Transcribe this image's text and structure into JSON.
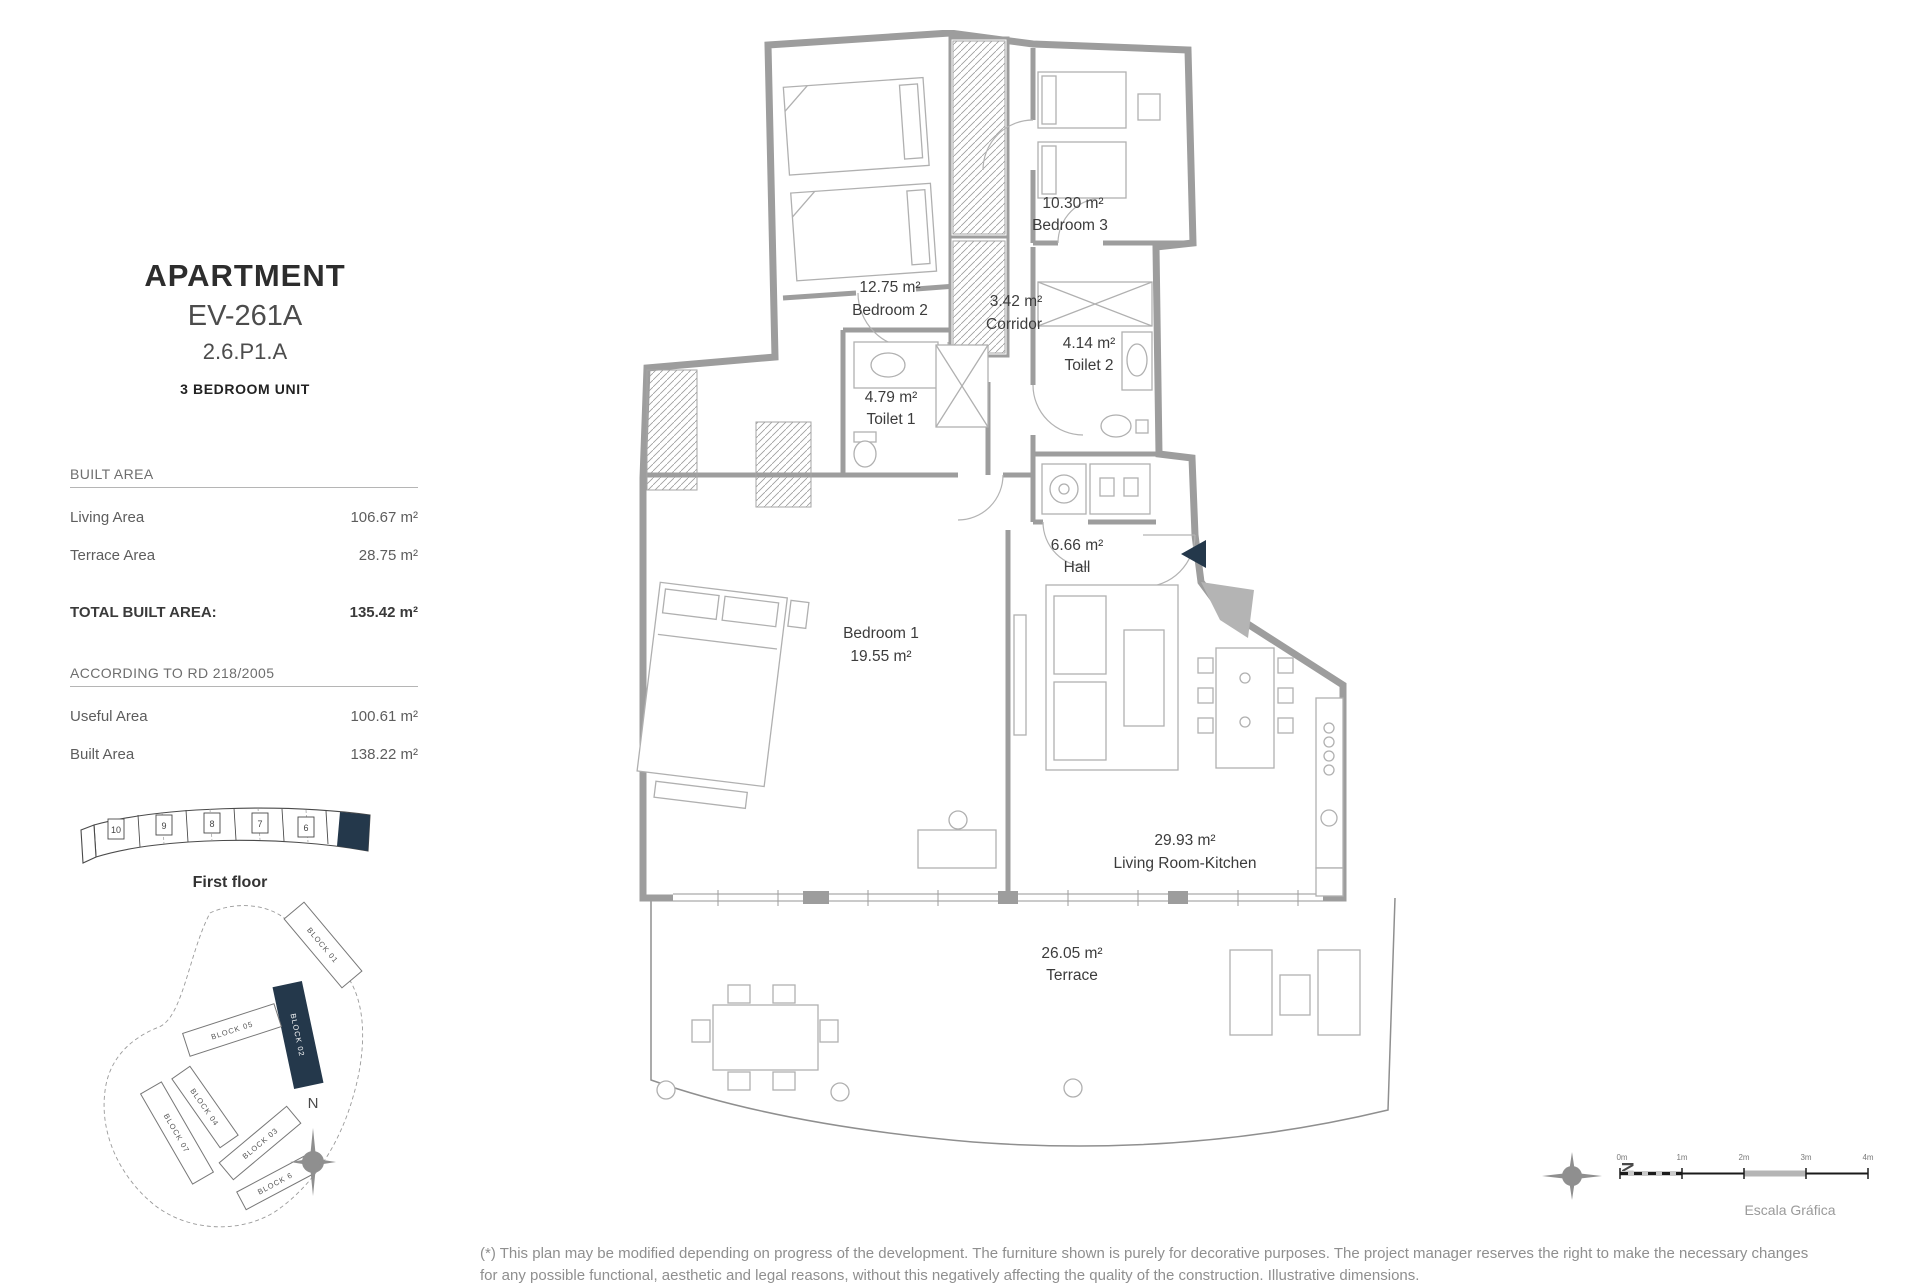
{
  "header": {
    "title": "APARTMENT",
    "unit_code": "EV-261A",
    "unit_ref": "2.6.P1.A",
    "unit_type": "3 BEDROOM UNIT"
  },
  "built_area": {
    "section_title": "BUILT AREA",
    "rows": [
      {
        "label": "Living Area",
        "value": "106.67 m²"
      },
      {
        "label": "Terrace Area",
        "value": "28.75 m²"
      }
    ],
    "total_label": "TOTAL BUILT AREA:",
    "total_value": "135.42 m²"
  },
  "rd_section": {
    "section_title": "ACCORDING TO RD 218/2005",
    "rows": [
      {
        "label": "Useful Area",
        "value": "100.61 m²"
      },
      {
        "label": "Built Area",
        "value": "138.22 m²"
      }
    ]
  },
  "floor_strip": {
    "label": "First floor",
    "units": [
      "10",
      "9",
      "8",
      "7",
      "6"
    ]
  },
  "site_plan": {
    "blocks": [
      "BLOCK 01",
      "BLOCK 02",
      "BLOCK 05",
      "BLOCK 04",
      "BLOCK 07",
      "BLOCK 03",
      "BLOCK 6"
    ],
    "highlighted_block": "BLOCK 02",
    "north_label": "N"
  },
  "floor_plan": {
    "rooms": [
      {
        "name": "Bedroom 3",
        "area": "10.30 m²"
      },
      {
        "name": "Bedroom 2",
        "area": "12.75 m²"
      },
      {
        "name": "Corridor",
        "area": "3.42 m²"
      },
      {
        "name": "Toilet 2",
        "area": "4.14 m²"
      },
      {
        "name": "Toilet 1",
        "area": "4.79 m²"
      },
      {
        "name": "Hall",
        "area": "6.66 m²"
      },
      {
        "name": "Bedroom 1",
        "area": "19.55 m²"
      },
      {
        "name": "Living Room-Kitchen",
        "area": "29.93 m²"
      },
      {
        "name": "Terrace",
        "area": "26.05 m²"
      }
    ]
  },
  "scale_bar": {
    "title": "Escala Gráfica",
    "ticks": [
      "0m",
      "1m",
      "2m",
      "3m",
      "4m"
    ],
    "north_label": "N"
  },
  "footer": {
    "disclaimer": "(*) This plan may be modified depending on progress of the development. The furniture shown is purely for decorative purposes. The project manager reserves the right to make the necessary changes for any possible functional, aesthetic and legal reasons, without this negatively affecting the quality of the construction. Illustrative dimensions."
  },
  "colors": {
    "highlight": "#24384b",
    "wall": "#9d9d9d",
    "furniture": "#b0b0b0",
    "text_dark": "#3c3c3c",
    "text_gray": "#8f8f8f"
  }
}
